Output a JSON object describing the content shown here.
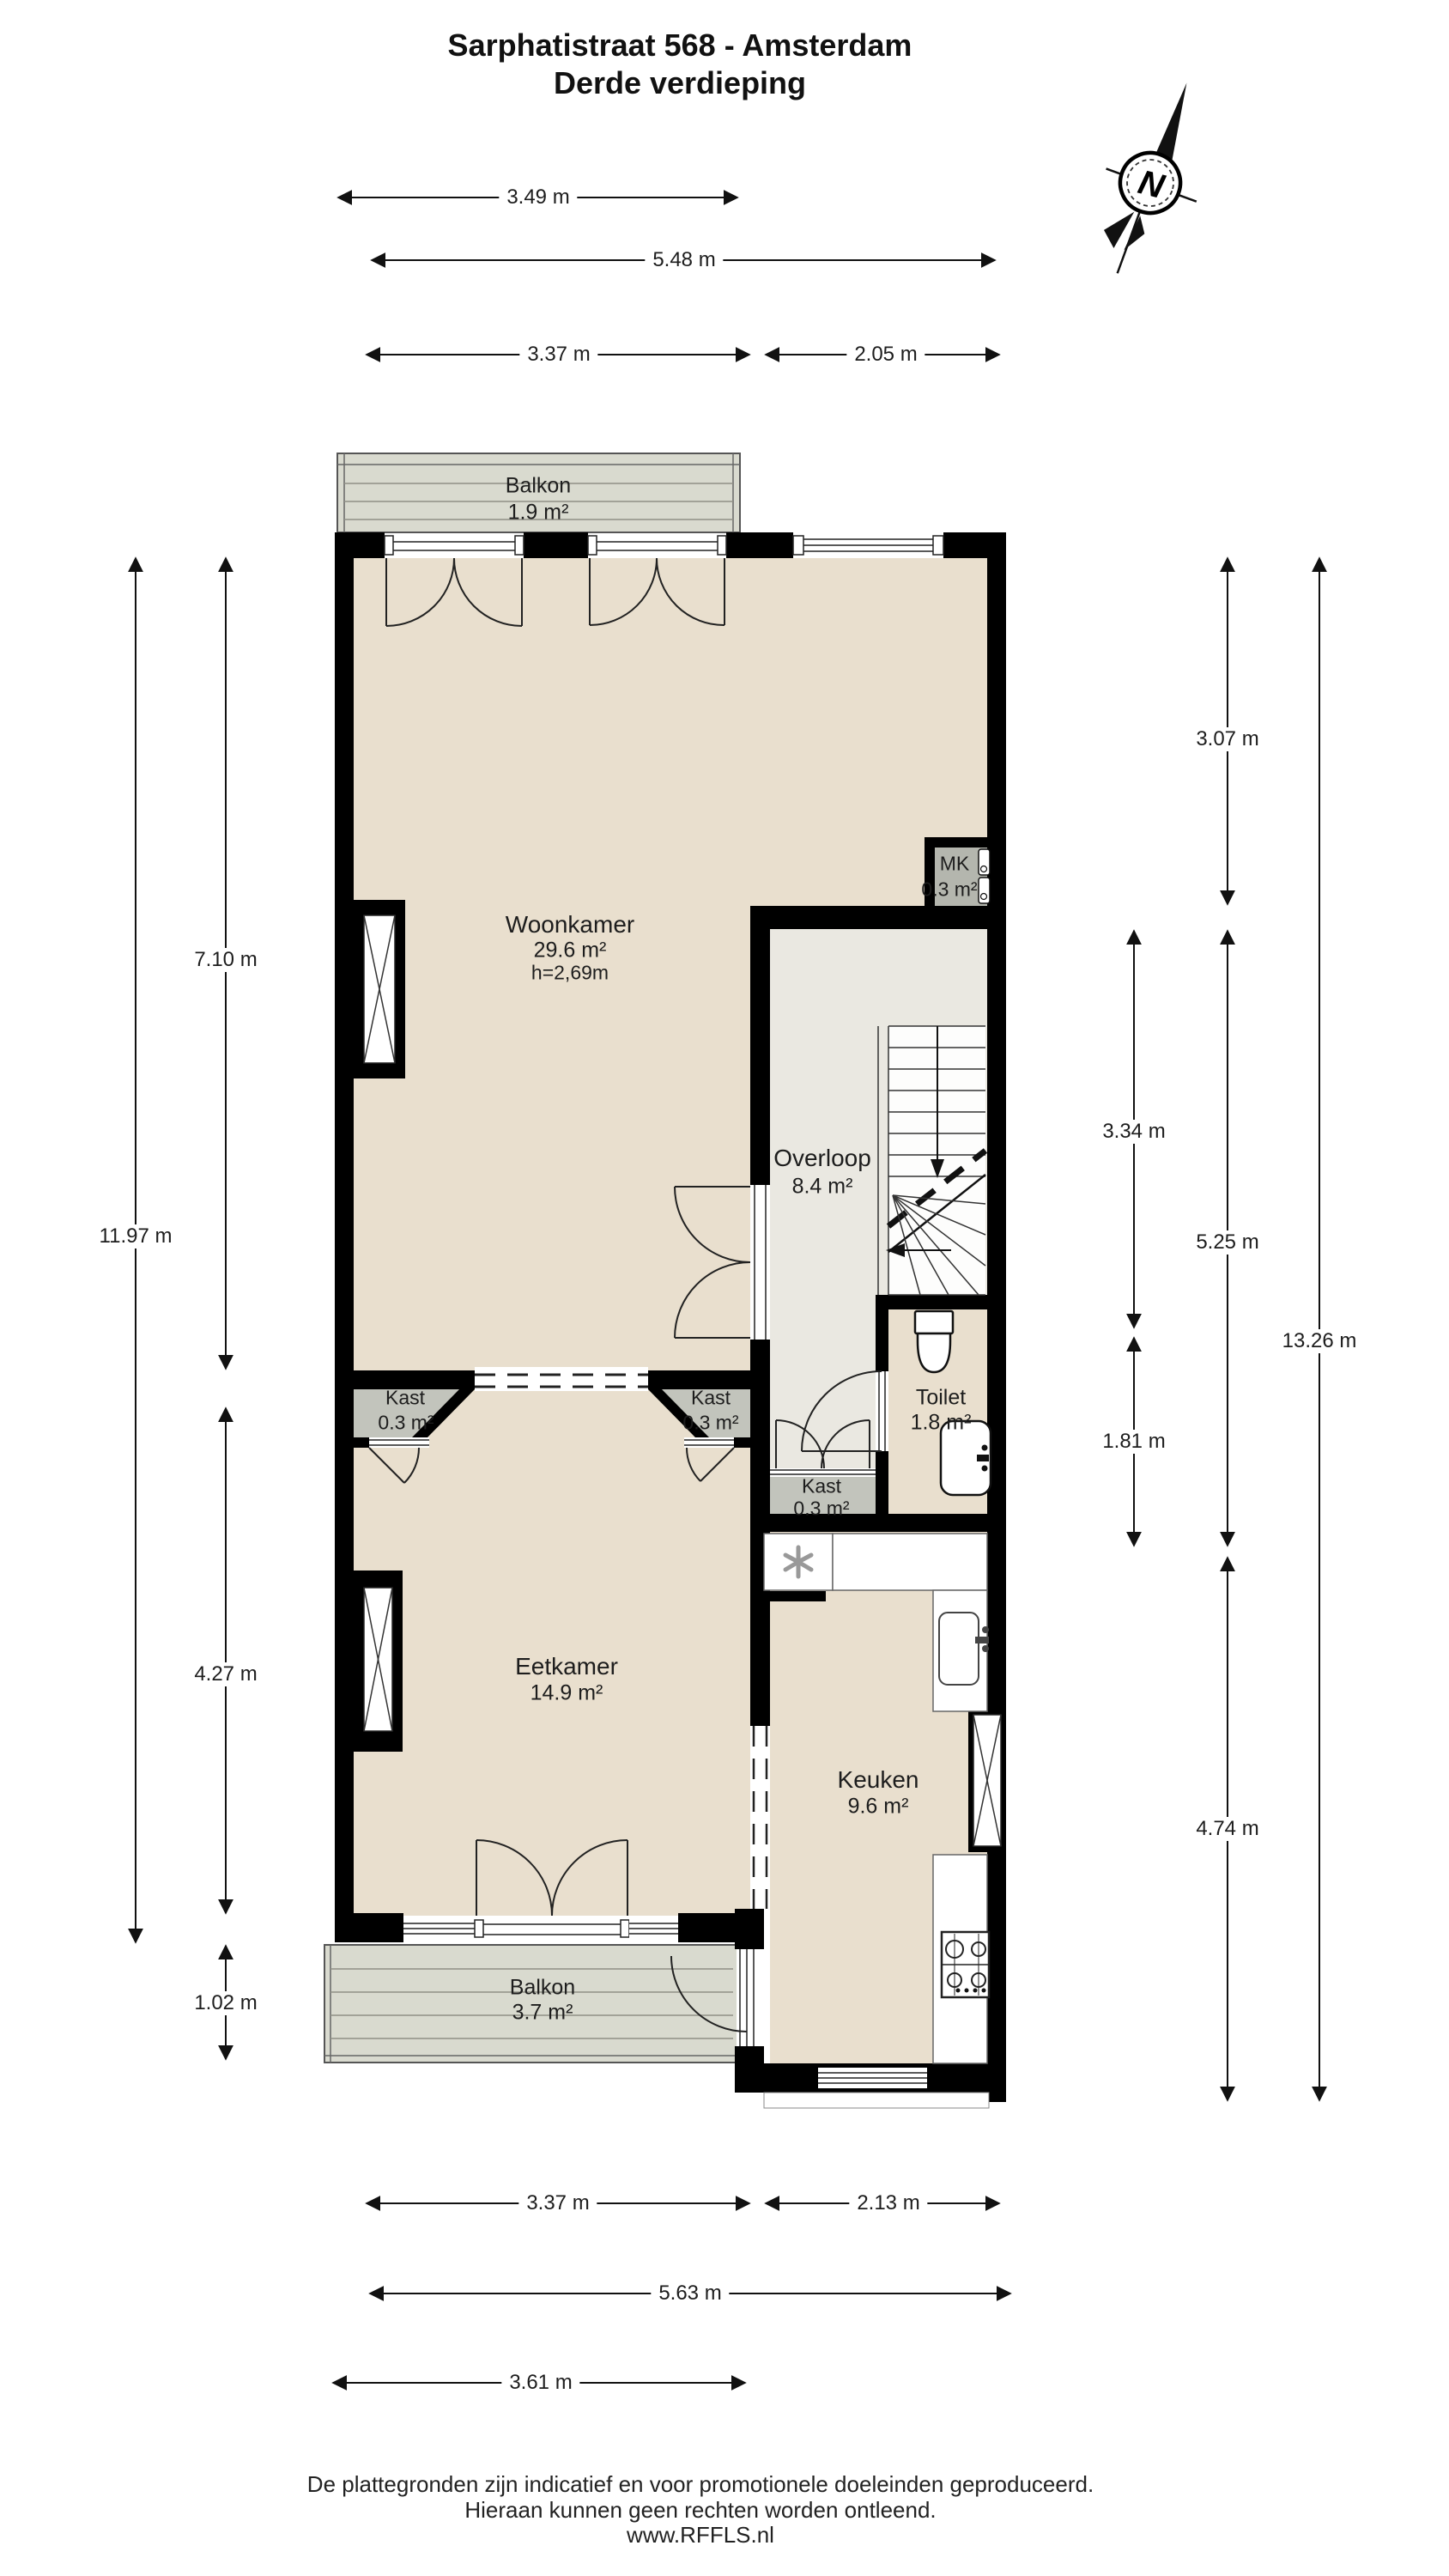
{
  "title": {
    "line1": "Sarphatistraat 568 - Amsterdam",
    "line2": "Derde verdieping"
  },
  "compass": {
    "letter": "N"
  },
  "rooms": {
    "balkon_noord": {
      "label": "Balkon",
      "area": "1.9 m²"
    },
    "woonkamer": {
      "label": "Woonkamer",
      "area": "29.6 m²",
      "ceiling": "h=2,69m"
    },
    "mk": {
      "label": "MK",
      "area": "0.3 m²"
    },
    "overloop": {
      "label": "Overloop",
      "area": "8.4 m²"
    },
    "toilet": {
      "label": "Toilet",
      "area": "1.8 m²"
    },
    "kast_links": {
      "label": "Kast",
      "area": "0.3 m²"
    },
    "kast_rechts": {
      "label": "Kast",
      "area": "0.3 m²"
    },
    "kast_overloop": {
      "label": "Kast",
      "area": "0.3 m²"
    },
    "eetkamer": {
      "label": "Eetkamer",
      "area": "14.9 m²"
    },
    "keuken": {
      "label": "Keuken",
      "area": "9.6 m²"
    },
    "balkon_zuid": {
      "label": "Balkon",
      "area": "3.7 m²"
    }
  },
  "dimensions": {
    "top": [
      "3.49 m",
      "5.48 m",
      "3.37 m",
      "2.05 m"
    ],
    "left": [
      "7.10 m",
      "11.97 m",
      "4.27 m",
      "1.02 m"
    ],
    "right": [
      "3.07 m",
      "3.34 m",
      "5.25 m",
      "1.81 m",
      "13.26 m",
      "4.74 m"
    ],
    "bottom": [
      "3.37 m",
      "2.13 m",
      "5.63 m",
      "3.61 m"
    ]
  },
  "footer": {
    "line1": "De plattegronden zijn indicatief en voor promotionele doeleinden geproduceerd.",
    "line2": "Hieraan kunnen geen rechten worden ontleend.",
    "line3": "www.RFFLS.nl"
  },
  "colors": {
    "room_fill": "#e9dfce",
    "hall_fill": "#eae8e1",
    "balcony_fill": "#d9dacf",
    "closet_fill": "#c2c4bc",
    "meter_fill": "#b4b6ae",
    "wall": "#000000"
  }
}
